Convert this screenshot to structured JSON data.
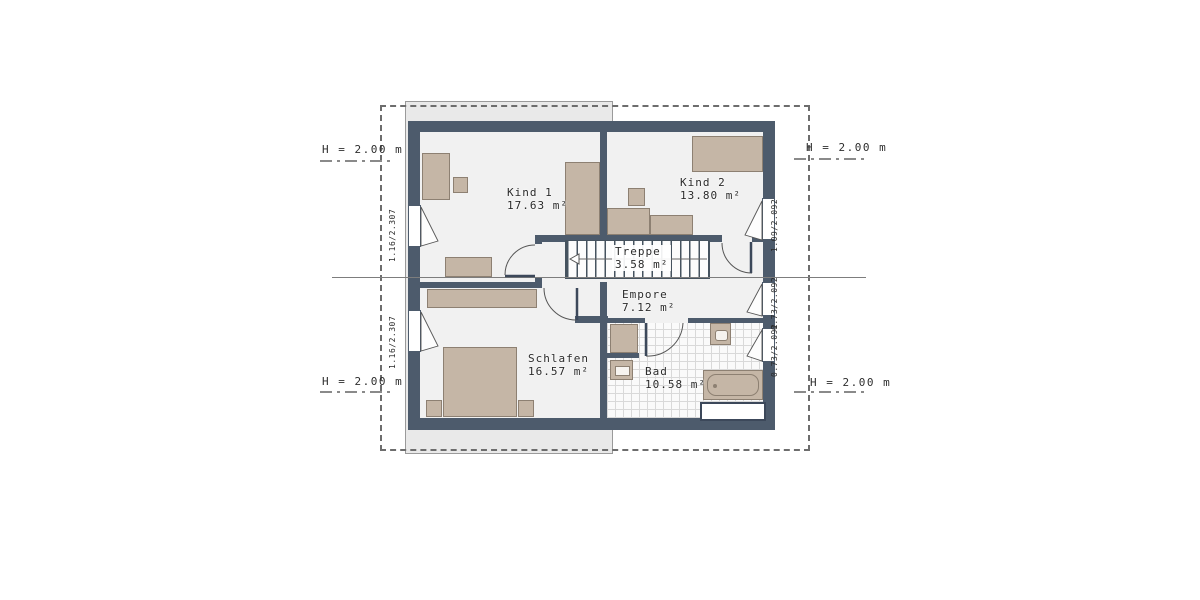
{
  "title": "floor-plan-upper-storey",
  "rooms": [
    {
      "name": "Kind 1",
      "area": "17.63 m²"
    },
    {
      "name": "Kind 2",
      "area": "13.80 m²"
    },
    {
      "name": "Treppe",
      "area": "3.58 m²"
    },
    {
      "name": "Empore",
      "area": "7.12 m²"
    },
    {
      "name": "Schlafen",
      "area": "16.57 m²"
    },
    {
      "name": "Bad",
      "area": "10.58 m²"
    }
  ],
  "annotations": {
    "heights": [
      "H = 2.00 m",
      "H = 2.00 m",
      "H = 2.00 m",
      "H = 2.00 m"
    ]
  },
  "windows": {
    "left_labels": [
      "1.16/2.307",
      "1.16/2.307"
    ],
    "right_labels": [
      "1.09/2.092",
      "0.73/2.092",
      "0.73/2.092"
    ]
  },
  "colors": {
    "wall": "#4d5b6c",
    "floor": "#f1f1f1",
    "furniture": "#c5b6a6",
    "furniture_border": "#8d8072",
    "roof_band": "#e9e9e9",
    "annotation": "#8a8a8a",
    "text": "#2b2b2b"
  }
}
